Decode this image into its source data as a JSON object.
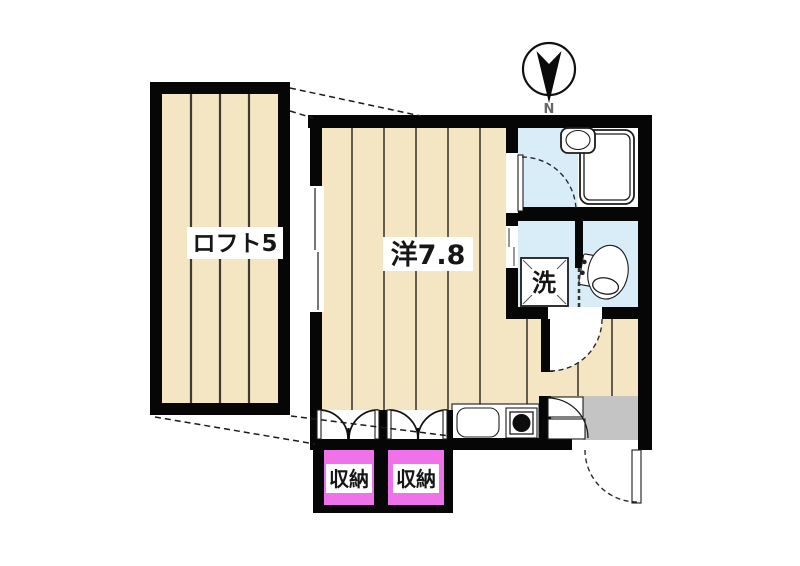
{
  "compass": {
    "label": "N"
  },
  "rooms": {
    "loft": {
      "label": "ロフト5"
    },
    "main": {
      "label": "洋7.8"
    },
    "storage_left": {
      "label": "収納"
    },
    "storage_right": {
      "label": "収納"
    },
    "washer": {
      "label": "洗"
    }
  },
  "colors": {
    "background": "#FFFFFF",
    "wall_black": "#060606",
    "floor_wood": "#F4E6C2",
    "water_blue": "#D9EDF8",
    "storage_pink": "#EF72EB",
    "entry_gray": "#C4C4C4",
    "plank_line": "#3E3C32"
  }
}
